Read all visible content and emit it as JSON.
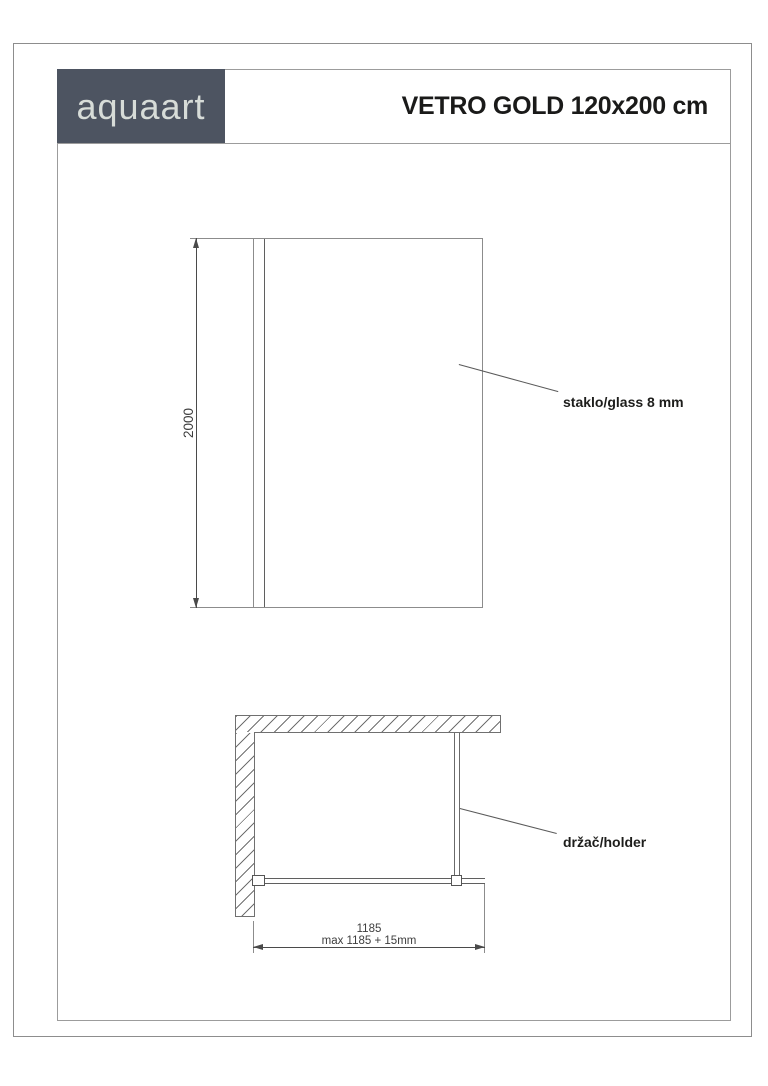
{
  "header": {
    "logo": "aquaart",
    "title": "VETRO GOLD 120x200 cm"
  },
  "elevation_view": {
    "height_dimension": "2000",
    "glass_label": "staklo/glass 8 mm"
  },
  "plan_view": {
    "width_dimension": "1185",
    "width_dimension_max": "max 1185 + 15mm",
    "holder_label": "držač/holder"
  },
  "colors": {
    "logo_background": "#4d5461",
    "logo_text": "#d7dcd8",
    "title_text": "#1a1a19",
    "drawing_line": "#707070",
    "dimension_line": "#4a4a4a",
    "dimension_text": "#3e3e3e",
    "label_text": "#1d1d1b"
  }
}
